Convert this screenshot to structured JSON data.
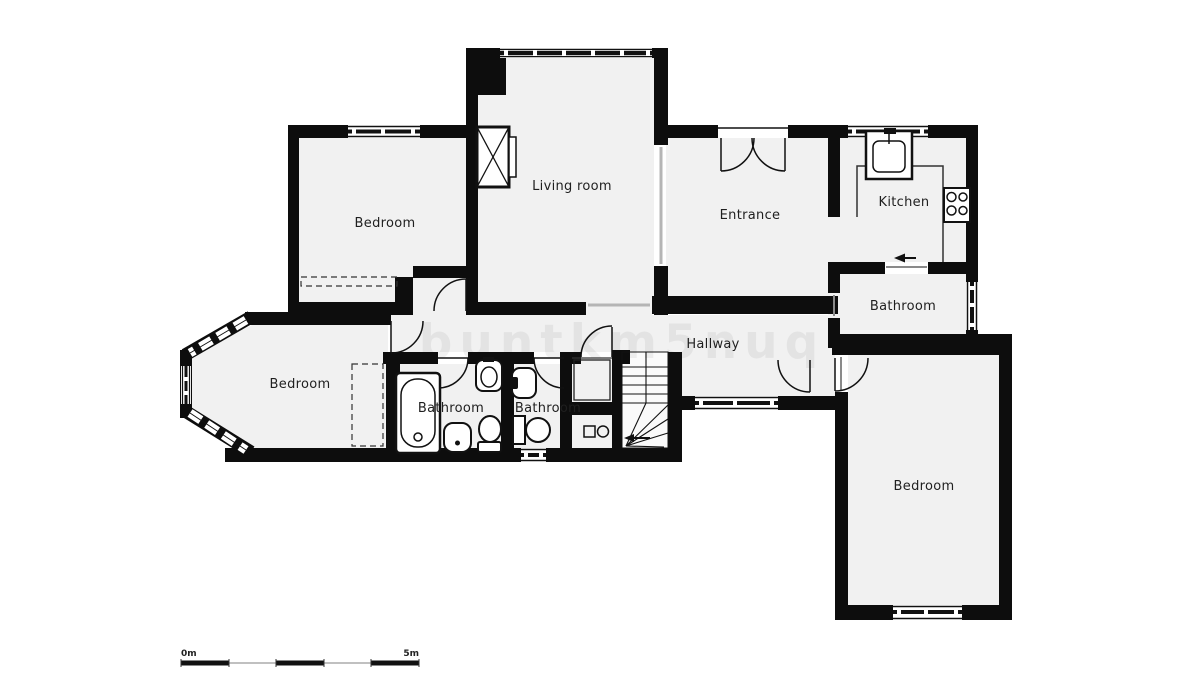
{
  "title": "Apartment floor plan",
  "watermark": "buntkm5nuq",
  "colors": {
    "background": "#ffffff",
    "floor": "#f1f1f1",
    "wall": "#0d0d0d",
    "line": "#1a1a1a",
    "opening": "#b5b5b5",
    "label": "#1f1f1f"
  },
  "rooms": [
    {
      "id": "bedroom-top-left",
      "label": "Bedroom"
    },
    {
      "id": "living-room",
      "label": "Living room"
    },
    {
      "id": "entrance",
      "label": "Entrance"
    },
    {
      "id": "kitchen",
      "label": "Kitchen"
    },
    {
      "id": "bathroom-top-right",
      "label": "Bathroom"
    },
    {
      "id": "hallway",
      "label": "Hallway"
    },
    {
      "id": "bedroom-left",
      "label": "Bedroom"
    },
    {
      "id": "bathroom-left",
      "label": "Bathroom"
    },
    {
      "id": "bathroom-center",
      "label": "Bathroom"
    },
    {
      "id": "bedroom-bottom-right",
      "label": "Bedroom"
    }
  ],
  "fixtures": [
    "fireplace",
    "kitchen-sink",
    "kitchen-counter",
    "stove",
    "bathtub",
    "sink",
    "toilet",
    "bidet",
    "washing-machine",
    "stairs",
    "wardrobe",
    "entry-arrow"
  ],
  "scale_bar": {
    "start_label": "0m",
    "end_label": "5m"
  }
}
